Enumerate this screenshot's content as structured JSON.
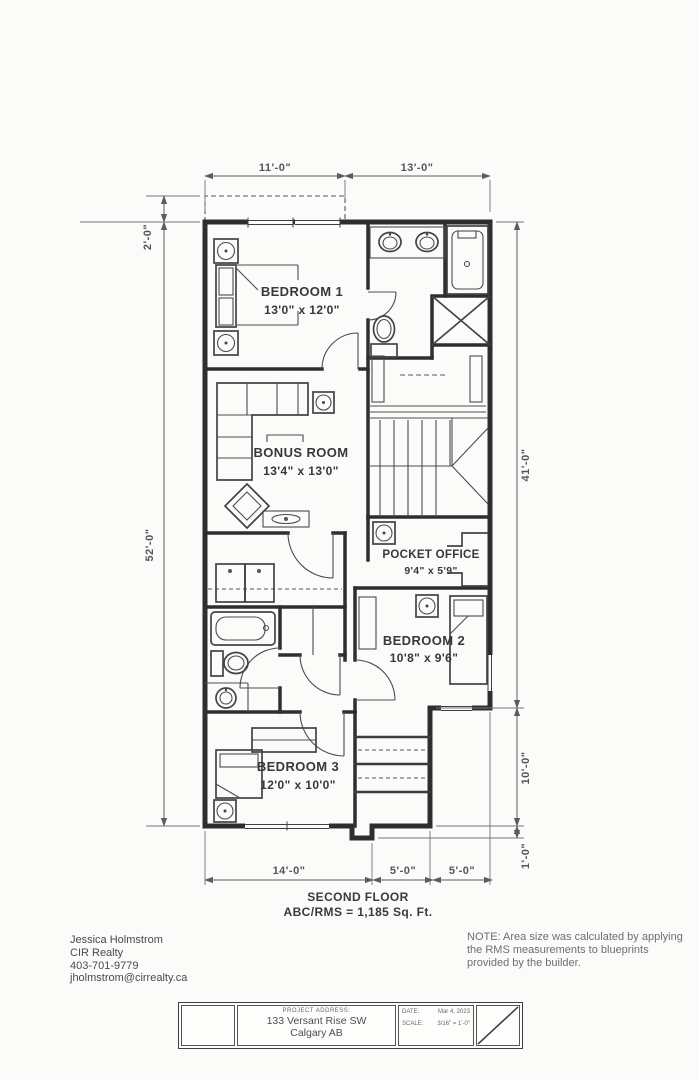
{
  "plan": {
    "title": "SECOND FLOOR",
    "area": "ABC/RMS = 1,185 Sq. Ft.",
    "rooms": {
      "bedroom1": {
        "name": "BEDROOM 1",
        "size": "13'0\" x 12'0\""
      },
      "bonus": {
        "name": "BONUS ROOM",
        "size": "13'4\" x 13'0\""
      },
      "pocket_office": {
        "name": "POCKET OFFICE",
        "size": "9'4\" x 5'9\""
      },
      "bedroom2": {
        "name": "BEDROOM 2",
        "size": "10'8\" x 9'6\""
      },
      "bedroom3": {
        "name": "BEDROOM 3",
        "size": "12'0\" x 10'0\""
      }
    },
    "dims": {
      "top_left": "11'-0\"",
      "top_right": "13'-0\"",
      "left_top": "2'-0\"",
      "left_overall": "52'-0\"",
      "right_upper": "41'-0\"",
      "right_lower": "10'-0\"",
      "right_bottom": "1'-0\"",
      "bottom_left": "14'-0\"",
      "bottom_middle": "5'-0\"",
      "bottom_right": "5'-0\""
    }
  },
  "footer": {
    "contact": {
      "name": "Jessica Holmstrom",
      "company": "CIR Realty",
      "phone": "403-701-9779",
      "email": "jholmstrom@cirrealty.ca"
    },
    "note": "NOTE: Area size was calculated by applying the RMS measurements to blueprints provided by the builder."
  },
  "title_block": {
    "project_address_label": "PROJECT ADDRESS:",
    "address_line1": "133 Versant Rise SW",
    "address_line2": "Calgary AB",
    "date_label": "DATE:",
    "date_value": "Mar 4, 2023",
    "scale_label": "SCALE:",
    "scale_value": "3/16\" = 1'-0\""
  }
}
